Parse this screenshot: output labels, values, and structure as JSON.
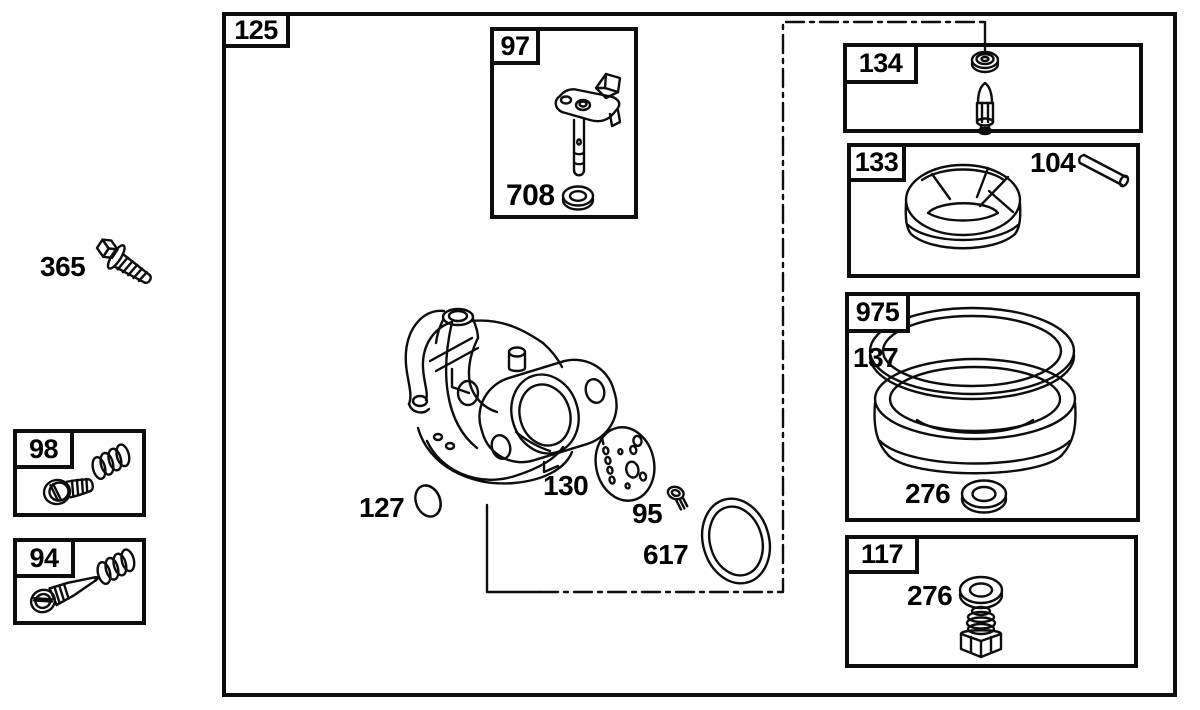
{
  "diagram": {
    "kind": "exploded-parts-diagram",
    "subject": "carburetor assembly",
    "ink_color": "#0d0d0d",
    "paper_color": "#ffffff"
  },
  "boxes": {
    "main": {
      "label": "125"
    },
    "throttle": {
      "label": "97",
      "washer": "708"
    },
    "needle_seat": {
      "label": "134"
    },
    "float": {
      "label": "133",
      "hinge_pin": "104"
    },
    "bowl": {
      "label": "975",
      "gasket": "137",
      "washer": "276"
    },
    "drain": {
      "label": "117",
      "washer": "276"
    },
    "idle_screw": {
      "label": "98"
    },
    "needle_valve": {
      "label": "94"
    }
  },
  "loose_parts": {
    "mounting_bolt": "365",
    "welch_plug": "127",
    "gasket": "130",
    "screw": "95",
    "o_ring": "617"
  }
}
